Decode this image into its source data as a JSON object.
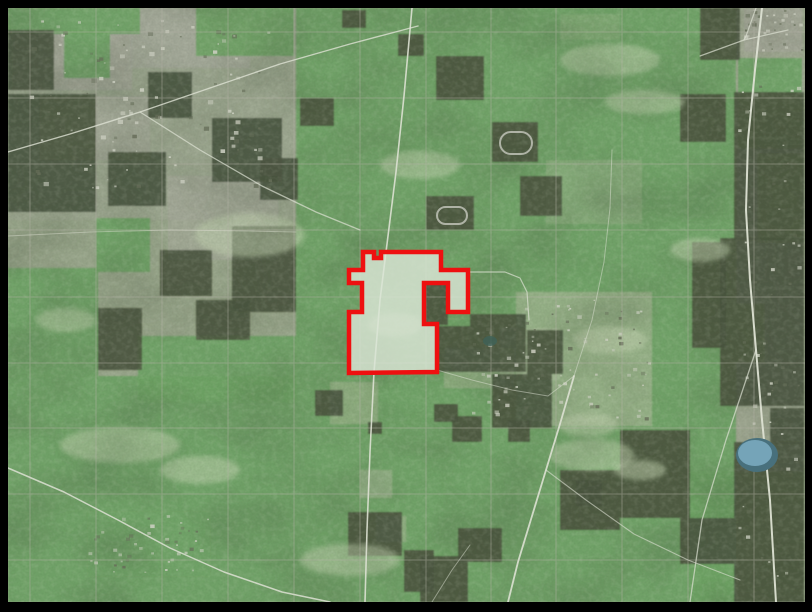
{
  "map": {
    "width": 812,
    "height": 612,
    "frame": {
      "color": "#000000",
      "left": 8,
      "top": 8,
      "right": 7,
      "bottom": 10
    },
    "colors": {
      "base": "#99a68b",
      "green": "#6fa465",
      "forest": "#4c5741",
      "urban": "#a7a99c",
      "pale_field": "#adbb9c",
      "road": "#dde1d3",
      "boundary": "#b5b2a7",
      "lake_rim": "#48707c",
      "lake_water": "#7aaabf",
      "pond": "#3f6157",
      "track": "#b9bdb0",
      "clearing": "#c3d4b1",
      "selection_fill": "#dbe5d6",
      "selection_stroke": "#ee1010",
      "speck_light": "#cccfc1",
      "speck_dark": "#666e59",
      "mottle": "#41503a",
      "grain_dark": "#313c2b",
      "grain_light": "#e4ead8"
    },
    "grey_under": [
      [
        8,
        8,
        290,
        212,
        0.35
      ],
      [
        12,
        10,
        120,
        80,
        0.8
      ],
      [
        130,
        8,
        120,
        60,
        0.7
      ],
      [
        40,
        96,
        110,
        64,
        0.6
      ],
      [
        168,
        176,
        110,
        84,
        0.55
      ],
      [
        88,
        512,
        122,
        64,
        0.65
      ],
      [
        744,
        8,
        58,
        44,
        0.8
      ],
      [
        736,
        8,
        68,
        596,
        0.4
      ]
    ],
    "green_base": [
      [
        296,
        8,
        440,
        594,
        0.92
      ],
      [
        8,
        376,
        288,
        226,
        0.92
      ]
    ],
    "grey_over": [
      [
        516,
        292,
        136,
        134,
        0.6
      ],
      [
        444,
        348,
        70,
        40,
        0.5
      ],
      [
        500,
        328,
        60,
        52,
        0.5
      ],
      [
        330,
        382,
        48,
        42,
        0.5
      ],
      [
        546,
        160,
        96,
        64,
        0.35
      ],
      [
        360,
        470,
        32,
        28,
        0.55
      ],
      [
        376,
        516,
        30,
        26,
        0.5
      ],
      [
        560,
        14,
        60,
        26,
        0.25
      ]
    ],
    "green_islands": [
      [
        8,
        8,
        132,
        26
      ],
      [
        196,
        8,
        98,
        48
      ],
      [
        64,
        30,
        46,
        48
      ],
      [
        8,
        268,
        90,
        108
      ],
      [
        96,
        218,
        54,
        54
      ],
      [
        138,
        336,
        158,
        66
      ],
      [
        738,
        58,
        64,
        90
      ],
      [
        758,
        154,
        44,
        88
      ],
      [
        736,
        304,
        28,
        58
      ],
      [
        690,
        472,
        114,
        130
      ]
    ],
    "dark_patches": [
      [
        8,
        30,
        46,
        60
      ],
      [
        8,
        94,
        88,
        118
      ],
      [
        148,
        72,
        44,
        46
      ],
      [
        212,
        118,
        70,
        64
      ],
      [
        260,
        158,
        38,
        42
      ],
      [
        232,
        226,
        64,
        86
      ],
      [
        108,
        152,
        58,
        54
      ],
      [
        160,
        250,
        52,
        46
      ],
      [
        98,
        308,
        44,
        62
      ],
      [
        196,
        300,
        54,
        40
      ],
      [
        436,
        56,
        48,
        44
      ],
      [
        492,
        122,
        46,
        40
      ],
      [
        426,
        196,
        48,
        34
      ],
      [
        398,
        34,
        26,
        22
      ],
      [
        300,
        98,
        34,
        28
      ],
      [
        520,
        176,
        42,
        40
      ],
      [
        424,
        283,
        24,
        42
      ],
      [
        437,
        326,
        33,
        46
      ],
      [
        470,
        314,
        56,
        58
      ],
      [
        492,
        374,
        60,
        54
      ],
      [
        527,
        330,
        36,
        44
      ],
      [
        508,
        420,
        22,
        22
      ],
      [
        452,
        416,
        30,
        26
      ],
      [
        434,
        404,
        24,
        18
      ],
      [
        315,
        390,
        28,
        26
      ],
      [
        368,
        422,
        14,
        12
      ],
      [
        348,
        512,
        54,
        44
      ],
      [
        404,
        550,
        30,
        42
      ],
      [
        458,
        528,
        44,
        34
      ],
      [
        420,
        556,
        48,
        46
      ],
      [
        560,
        470,
        60,
        60
      ],
      [
        620,
        430,
        70,
        88
      ],
      [
        680,
        518,
        54,
        46
      ],
      [
        576,
        480,
        26,
        26
      ],
      [
        680,
        94,
        46,
        48
      ],
      [
        692,
        242,
        34,
        106
      ],
      [
        342,
        10,
        24,
        18
      ],
      [
        734,
        92,
        70,
        148
      ],
      [
        720,
        238,
        84,
        168
      ],
      [
        734,
        442,
        70,
        160
      ],
      [
        700,
        8,
        40,
        52
      ],
      [
        770,
        408,
        34,
        36
      ]
    ],
    "clearings": [
      [
        250,
        235,
        55,
        22
      ],
      [
        120,
        445,
        60,
        18
      ],
      [
        200,
        470,
        40,
        14
      ],
      [
        610,
        60,
        50,
        16
      ],
      [
        645,
        102,
        40,
        12
      ],
      [
        592,
        455,
        42,
        16
      ],
      [
        700,
        250,
        30,
        12
      ],
      [
        420,
        165,
        40,
        14
      ],
      [
        350,
        560,
        50,
        16
      ],
      [
        610,
        340,
        36,
        14
      ],
      [
        66,
        320,
        30,
        12
      ],
      [
        395,
        325,
        28,
        12
      ],
      [
        588,
        425,
        30,
        12
      ],
      [
        640,
        470,
        26,
        10
      ]
    ],
    "speck_clusters": [
      {
        "x": 20,
        "y": 18,
        "w": 250,
        "h": 170,
        "count": 110,
        "seed": 3,
        "size": 4
      },
      {
        "x": 88,
        "y": 514,
        "w": 120,
        "h": 58,
        "count": 45,
        "seed": 5,
        "size": 3
      },
      {
        "x": 742,
        "y": 10,
        "w": 60,
        "h": 44,
        "count": 30,
        "seed": 8,
        "size": 3
      },
      {
        "x": 738,
        "y": 60,
        "w": 60,
        "h": 530,
        "count": 70,
        "seed": 11,
        "size": 3
      },
      {
        "x": 520,
        "y": 296,
        "w": 130,
        "h": 126,
        "count": 60,
        "seed": 13,
        "size": 3
      },
      {
        "x": 470,
        "y": 320,
        "w": 60,
        "h": 100,
        "count": 30,
        "seed": 17,
        "size": 3
      }
    ],
    "boundary_grid": {
      "vertical_x": [
        30,
        96,
        162,
        228,
        294,
        360,
        426,
        491,
        556,
        622,
        688,
        754
      ],
      "horizontal_y": [
        32,
        98,
        164,
        230,
        297,
        363,
        428,
        494,
        560
      ],
      "opacity": 0.45,
      "width": 1
    },
    "roads": [
      {
        "points": [
          [
            412,
            8
          ],
          [
            404,
            96
          ],
          [
            396,
            172
          ],
          [
            388,
            236
          ],
          [
            380,
            300
          ],
          [
            374,
            372
          ],
          [
            370,
            452
          ],
          [
            367,
            530
          ],
          [
            365,
            602
          ]
        ],
        "width": 1.6,
        "opacity": 0.9
      },
      {
        "points": [
          [
            762,
            8
          ],
          [
            755,
            70
          ],
          [
            748,
            140
          ],
          [
            746,
            210
          ],
          [
            750,
            280
          ],
          [
            756,
            350
          ],
          [
            762,
            420
          ],
          [
            770,
            500
          ],
          [
            776,
            602
          ]
        ],
        "width": 2,
        "opacity": 0.95
      },
      {
        "points": [
          [
            8,
            152
          ],
          [
            70,
            134
          ],
          [
            140,
            112
          ],
          [
            210,
            88
          ],
          [
            280,
            64
          ],
          [
            350,
            44
          ],
          [
            418,
            26
          ]
        ],
        "width": 1.4,
        "opacity": 0.8
      },
      {
        "points": [
          [
            140,
            112
          ],
          [
            200,
            150
          ],
          [
            262,
            186
          ],
          [
            316,
            212
          ],
          [
            360,
            230
          ]
        ],
        "width": 1.3,
        "opacity": 0.7
      },
      {
        "points": [
          [
            8,
            468
          ],
          [
            64,
            492
          ],
          [
            118,
            520
          ],
          [
            170,
            548
          ],
          [
            224,
            572
          ],
          [
            282,
            592
          ],
          [
            330,
            602
          ]
        ],
        "width": 1.5,
        "opacity": 0.85
      },
      {
        "points": [
          [
            574,
            376
          ],
          [
            560,
            424
          ],
          [
            546,
            470
          ],
          [
            532,
            516
          ],
          [
            518,
            562
          ],
          [
            508,
            602
          ]
        ],
        "width": 1.8,
        "opacity": 0.9
      },
      {
        "points": [
          [
            546,
            470
          ],
          [
            586,
            500
          ],
          [
            634,
            534
          ],
          [
            688,
            560
          ],
          [
            740,
            580
          ]
        ],
        "width": 1.1,
        "opacity": 0.6
      },
      {
        "points": [
          [
            756,
            350
          ],
          [
            726,
            440
          ],
          [
            702,
            520
          ],
          [
            690,
            602
          ]
        ],
        "width": 1.3,
        "opacity": 0.7
      },
      {
        "points": [
          [
            468,
            272
          ],
          [
            505,
            272
          ],
          [
            520,
            278
          ],
          [
            527,
            292
          ],
          [
            529,
            320
          ]
        ],
        "width": 1.2,
        "opacity": 0.7
      },
      {
        "points": [
          [
            8,
            236
          ],
          [
            90,
            232
          ],
          [
            170,
            230
          ],
          [
            250,
            231
          ],
          [
            296,
            232
          ]
        ],
        "width": 1,
        "opacity": 0.45
      },
      {
        "points": [
          [
            700,
            56
          ],
          [
            744,
            40
          ],
          [
            788,
            30
          ]
        ],
        "width": 1.2,
        "opacity": 0.7
      },
      {
        "points": [
          [
            756,
            8
          ],
          [
            746,
            36
          ],
          [
            744,
            40
          ]
        ],
        "width": 1.2,
        "opacity": 0.7
      },
      {
        "points": [
          [
            574,
            376
          ],
          [
            592,
            320
          ],
          [
            604,
            262
          ],
          [
            610,
            208
          ],
          [
            612,
            150
          ]
        ],
        "width": 1,
        "opacity": 0.5
      },
      {
        "points": [
          [
            437,
            370
          ],
          [
            472,
            380
          ],
          [
            512,
            390
          ],
          [
            548,
            396
          ],
          [
            574,
            376
          ]
        ],
        "width": 1,
        "opacity": 0.5
      },
      {
        "points": [
          [
            432,
            602
          ],
          [
            452,
            570
          ],
          [
            470,
            545
          ]
        ],
        "width": 1,
        "opacity": 0.5
      }
    ],
    "lake": {
      "cx": 757,
      "cy": 455,
      "rx": 21,
      "ry": 17
    },
    "pond": {
      "cx": 490,
      "cy": 341,
      "rx": 7,
      "ry": 5
    },
    "tracks": [
      {
        "x": 500,
        "y": 132,
        "w": 32,
        "h": 22
      },
      {
        "x": 437,
        "y": 207,
        "w": 30,
        "h": 17
      }
    ],
    "selected_parcel": {
      "points": [
        [
          363,
          252
        ],
        [
          374,
          252
        ],
        [
          374,
          258
        ],
        [
          381,
          258
        ],
        [
          381,
          252
        ],
        [
          441,
          252
        ],
        [
          441,
          270
        ],
        [
          468,
          270
        ],
        [
          468,
          312
        ],
        [
          448,
          312
        ],
        [
          448,
          283
        ],
        [
          424,
          283
        ],
        [
          424,
          324
        ],
        [
          437,
          324
        ],
        [
          437,
          372
        ],
        [
          349,
          373
        ],
        [
          349,
          312
        ],
        [
          362,
          312
        ],
        [
          362,
          283
        ],
        [
          349,
          283
        ],
        [
          349,
          270
        ],
        [
          363,
          270
        ]
      ],
      "stroke_width": 4.5,
      "fill_opacity": 0.82
    }
  }
}
